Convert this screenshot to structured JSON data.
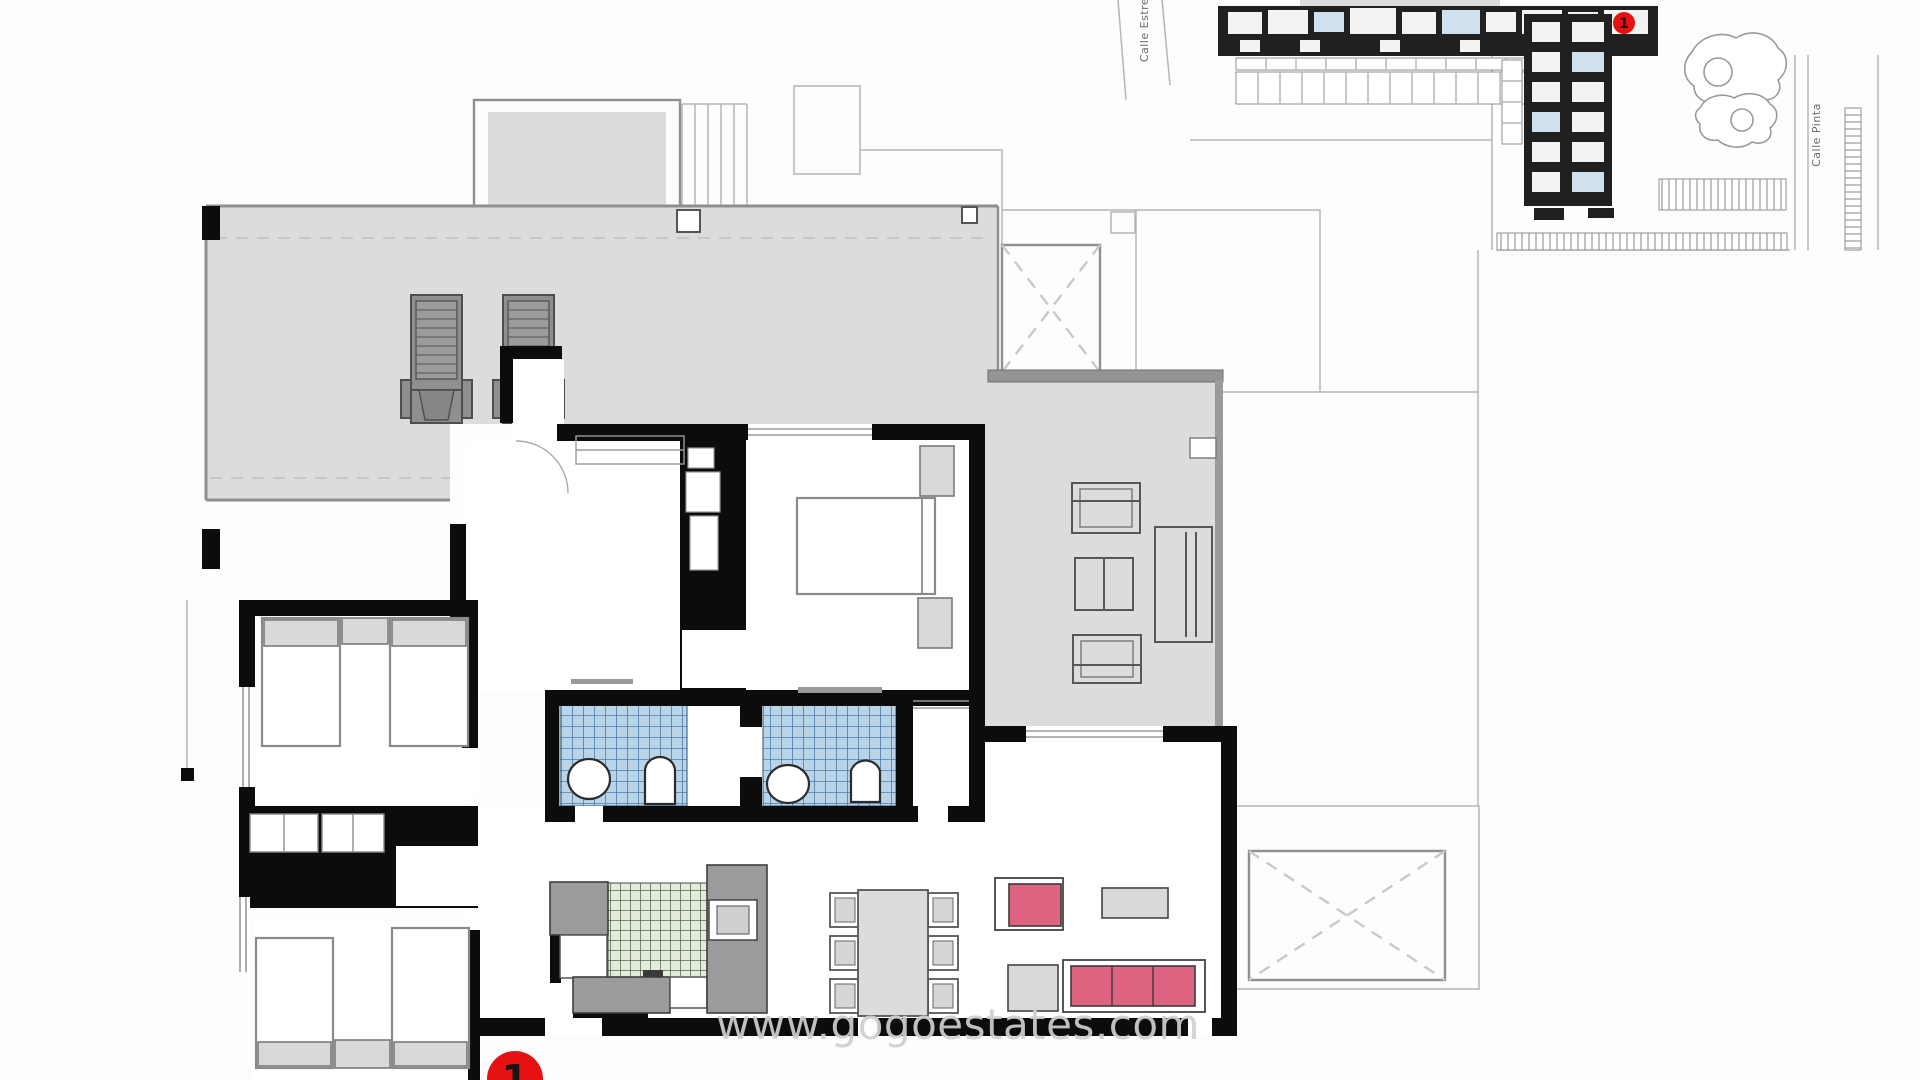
{
  "watermark": {
    "text": "www.gogoestates.com"
  },
  "unit_badge": {
    "label": "1"
  },
  "site_plan": {
    "marker_label": "1",
    "street_label_left": "Calle Estre",
    "street_label_right": "Calle Pinta"
  },
  "palette": {
    "wall": "#0c0c0c",
    "terrace": "#dcdcdc",
    "line": "#8f8f8f",
    "thin_line": "#b5b5b5",
    "tile_blue": "#b9d3e8",
    "tile_blue_line": "#4d7ca8",
    "tile_green": "#e2ebdc",
    "tile_green_line": "#55654f",
    "counter": "#9b9b9b",
    "furniture_gray": "#d9d9d9",
    "lounger_gray": "#8f8f8f",
    "sofa_pink": "#dd6480",
    "marker_red": "#e61212",
    "watermark_gray": "#d0d0d0",
    "building_dark": "#202020"
  }
}
